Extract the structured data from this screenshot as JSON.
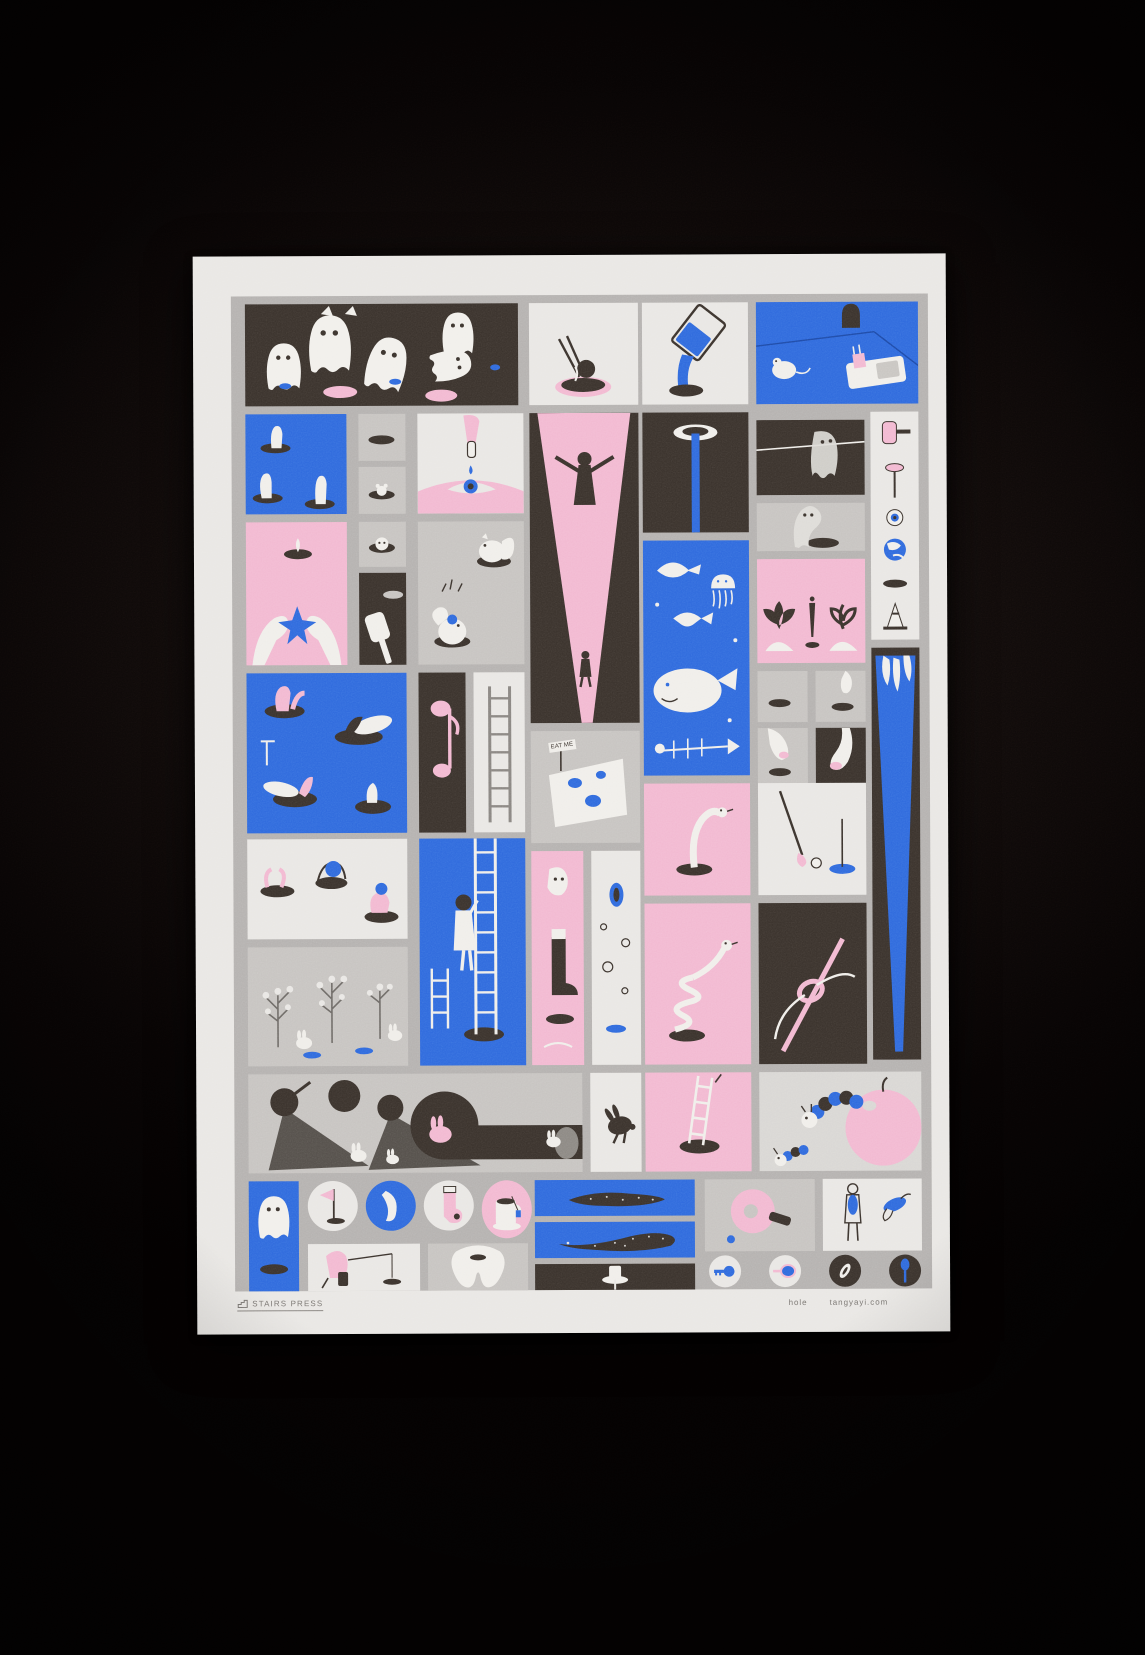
{
  "photo": {
    "subject": "risograph art print poster photographed on a dark textured surface"
  },
  "poster": {
    "publisher": "STAIRS PRESS",
    "title": "hole",
    "website": "tangyayi.com",
    "cheese_sign": "EAT ME",
    "palette": {
      "blue": "#2f6add",
      "pink": "#f2b9d1",
      "dark_brown": "#3a322c",
      "gray": "#c7c4c1",
      "paper": "#e9e7e4",
      "grid_silver": "#b5b2b0"
    },
    "panels": [
      {
        "name": "ghost-party",
        "desc": "Dark panel with white ghosts floating above pink manhole lids"
      },
      {
        "name": "noodle-hole",
        "desc": "Chopsticks lifting noodles out of a pink-rimmed hole"
      },
      {
        "name": "pouring-glass",
        "desc": "Tilted glass pouring blue water into a hole"
      },
      {
        "name": "mousetrap-room",
        "desc": "Blue room with mouse hole in wall, mousetrap with pink cheese and a white mouse"
      },
      {
        "name": "finger-holes",
        "desc": "Blue panel with white fingers poking out of holes"
      },
      {
        "name": "small-hole",
        "desc": "Small gray panel with an empty dark hole"
      },
      {
        "name": "small-hole-mouse",
        "desc": "Small gray panel with a tiny creature peeking from a hole"
      },
      {
        "name": "eye-dropper",
        "desc": "Hand squeezing an eye dropper with a blue drop into an eye"
      },
      {
        "name": "light-beam",
        "desc": "Pink light beam in darkness with a silhouetted figure"
      },
      {
        "name": "sink-drain",
        "desc": "Dark panel, blue stream falling from a white hole"
      },
      {
        "name": "ghost-clothesline",
        "desc": "Ghost draped over a clothesline like drying laundry"
      },
      {
        "name": "object-strip",
        "desc": "White strip of small objects: pink hammer, pushpin, eyeball, globe, hole, traffic cone"
      },
      {
        "name": "star-pickup",
        "desc": "Pink panel, two feet lifting a blue star from a hole"
      },
      {
        "name": "peek-face",
        "desc": "Small face peeking out of a ring-shaped hole"
      },
      {
        "name": "mole-mallet",
        "desc": "White mallet over a dark whack-a-mole hole"
      },
      {
        "name": "squirrel-burrows",
        "desc": "Gray panel, fluffy squirrels popping out of burrow holes"
      },
      {
        "name": "undersea",
        "desc": "Blue underwater scene with whale, jellyfish, ray, fish and bones"
      },
      {
        "name": "ghost-slump",
        "desc": "Ghost slumped over a hole on gray ground"
      },
      {
        "name": "garden",
        "desc": "Pink garden panel with radish, carrot and sprout growing from mounds"
      },
      {
        "name": "wedge-claw",
        "desc": "Tall dark panel with a blue wedge of light and a white hand reaching in"
      },
      {
        "name": "manhole-divers",
        "desc": "Blue panel, people diving into open manholes, legs sticking out"
      },
      {
        "name": "pink-note",
        "desc": "Dark panel with a pink musical-note shaped balloon"
      },
      {
        "name": "ladder-up",
        "desc": "A ladder standing in a white panel"
      },
      {
        "name": "eat-me-cheese",
        "desc": "Cheese wedge with blue holes and an EAT ME sign",
        "sign": "EAT ME"
      },
      {
        "name": "hole-small",
        "desc": "Small gray panel with a hole"
      },
      {
        "name": "finger-over-hole",
        "desc": "White finger hovering above a small hole"
      },
      {
        "name": "fingertip-hole",
        "desc": "Fingertip with pink nail pointing at a hole"
      },
      {
        "name": "finger-dark",
        "desc": "White finger with pink nail on a dark panel"
      },
      {
        "name": "hole-players",
        "desc": "People playing in street holes, legs and heads sticking out"
      },
      {
        "name": "ladder-climber",
        "desc": "Blue panel, girl climbing a tall ladder out of a hole"
      },
      {
        "name": "boot-step",
        "desc": "Pink panel with a white boot stepping over a hole"
      },
      {
        "name": "bubble-holes",
        "desc": "White panel with bubbles and a blue vertical hole"
      },
      {
        "name": "snake-out",
        "desc": "White snake rising out of a hole on pink"
      },
      {
        "name": "spring-coil",
        "desc": "White spring coil bouncing from a hole on pink"
      },
      {
        "name": "golf-putt",
        "desc": "Golf club putting a ball toward a blue hole"
      },
      {
        "name": "needle-thread",
        "desc": "Pink needle with thread through its eye on dark"
      },
      {
        "name": "twig-garden",
        "desc": "Gray panel with berry twigs, white rabbits and small blue holes"
      },
      {
        "name": "shadow-rabbits",
        "desc": "Long shadows and burrow tunnel with white and pink rabbits"
      },
      {
        "name": "rabbit-silhouette",
        "desc": "Dark leaping rabbit silhouette"
      },
      {
        "name": "ladder-out",
        "desc": "Ladder leaning out of a hole on pink"
      },
      {
        "name": "caterpillar-apple",
        "desc": "Blue striped caterpillars burrowing into a pink apple"
      },
      {
        "name": "ghost-column",
        "desc": "Narrow blue panel, ghost hovering above a hole"
      },
      {
        "name": "circle-golf-flag",
        "desc": "Round vignette of a pink golf flag in a hole"
      },
      {
        "name": "circle-blue-crescent",
        "desc": "Blue round vignette with a white curved object"
      },
      {
        "name": "circle-sock",
        "desc": "Round vignette of a pink sock with a hole"
      },
      {
        "name": "circle-mug",
        "desc": "Pink oval vignette of a mug of coffee on a saucer"
      },
      {
        "name": "eel-swim-1",
        "desc": "Speckled dark eel swimming across a blue panel"
      },
      {
        "name": "fisher",
        "desc": "Pink figure on a stool fishing into a tiny hole"
      },
      {
        "name": "tooth-cavity",
        "desc": "Big white tooth with a dark cavity hole"
      },
      {
        "name": "eel-swim-2",
        "desc": "Speckled dark whale-shark gliding across a blue panel"
      },
      {
        "name": "sprinkler",
        "desc": "White sprinkler popping from a hole in the dark"
      },
      {
        "name": "paddle-hole",
        "desc": "Pink table-tennis paddle with a hole and a blue ball"
      },
      {
        "name": "hole-hugger",
        "desc": "Figure hugging a blue hole; hand reaching through another"
      },
      {
        "name": "circle-key",
        "desc": "Round vignette of a blue key"
      },
      {
        "name": "circle-pan",
        "desc": "Round vignette of a pan filled with blue"
      },
      {
        "name": "circle-coin",
        "desc": "Dark round vignette of a white ring coin"
      },
      {
        "name": "circle-spoon",
        "desc": "Dark round vignette of a blue spoon"
      }
    ]
  }
}
